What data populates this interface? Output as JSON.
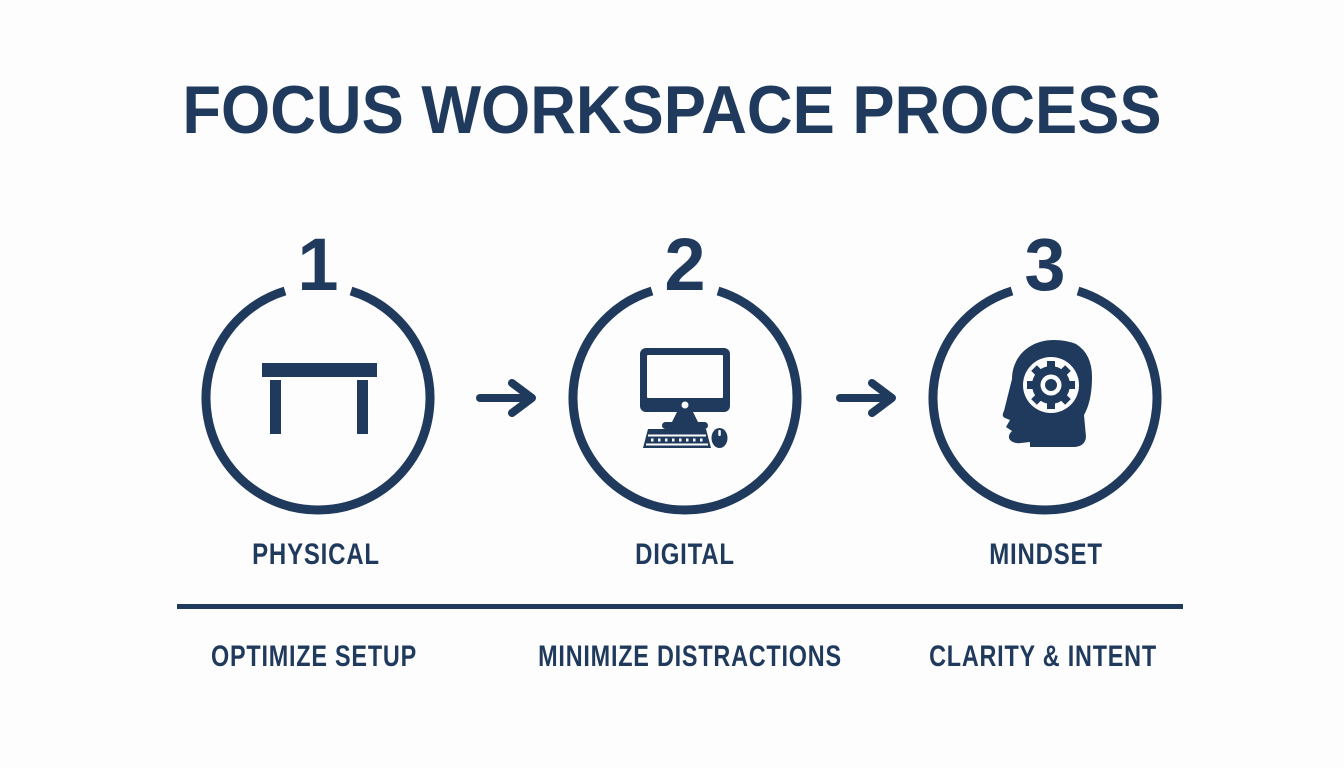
{
  "title": "FOCUS WORKSPACE PROCESS",
  "colors": {
    "navy": "#1f3a5c",
    "background": "#fdfdfd"
  },
  "steps": [
    {
      "number": "1",
      "icon": "desk-icon",
      "label": "PHYSICAL",
      "caption": "OPTIMIZE SETUP"
    },
    {
      "number": "2",
      "icon": "computer-icon",
      "label": "DIGITAL",
      "caption": "MINIMIZE DISTRACTIONS"
    },
    {
      "number": "3",
      "icon": "head-gear-icon",
      "label": "MINDSET",
      "caption": "CLARITY & INTENT"
    }
  ],
  "connector": {
    "icon": "arrow-right-icon"
  }
}
